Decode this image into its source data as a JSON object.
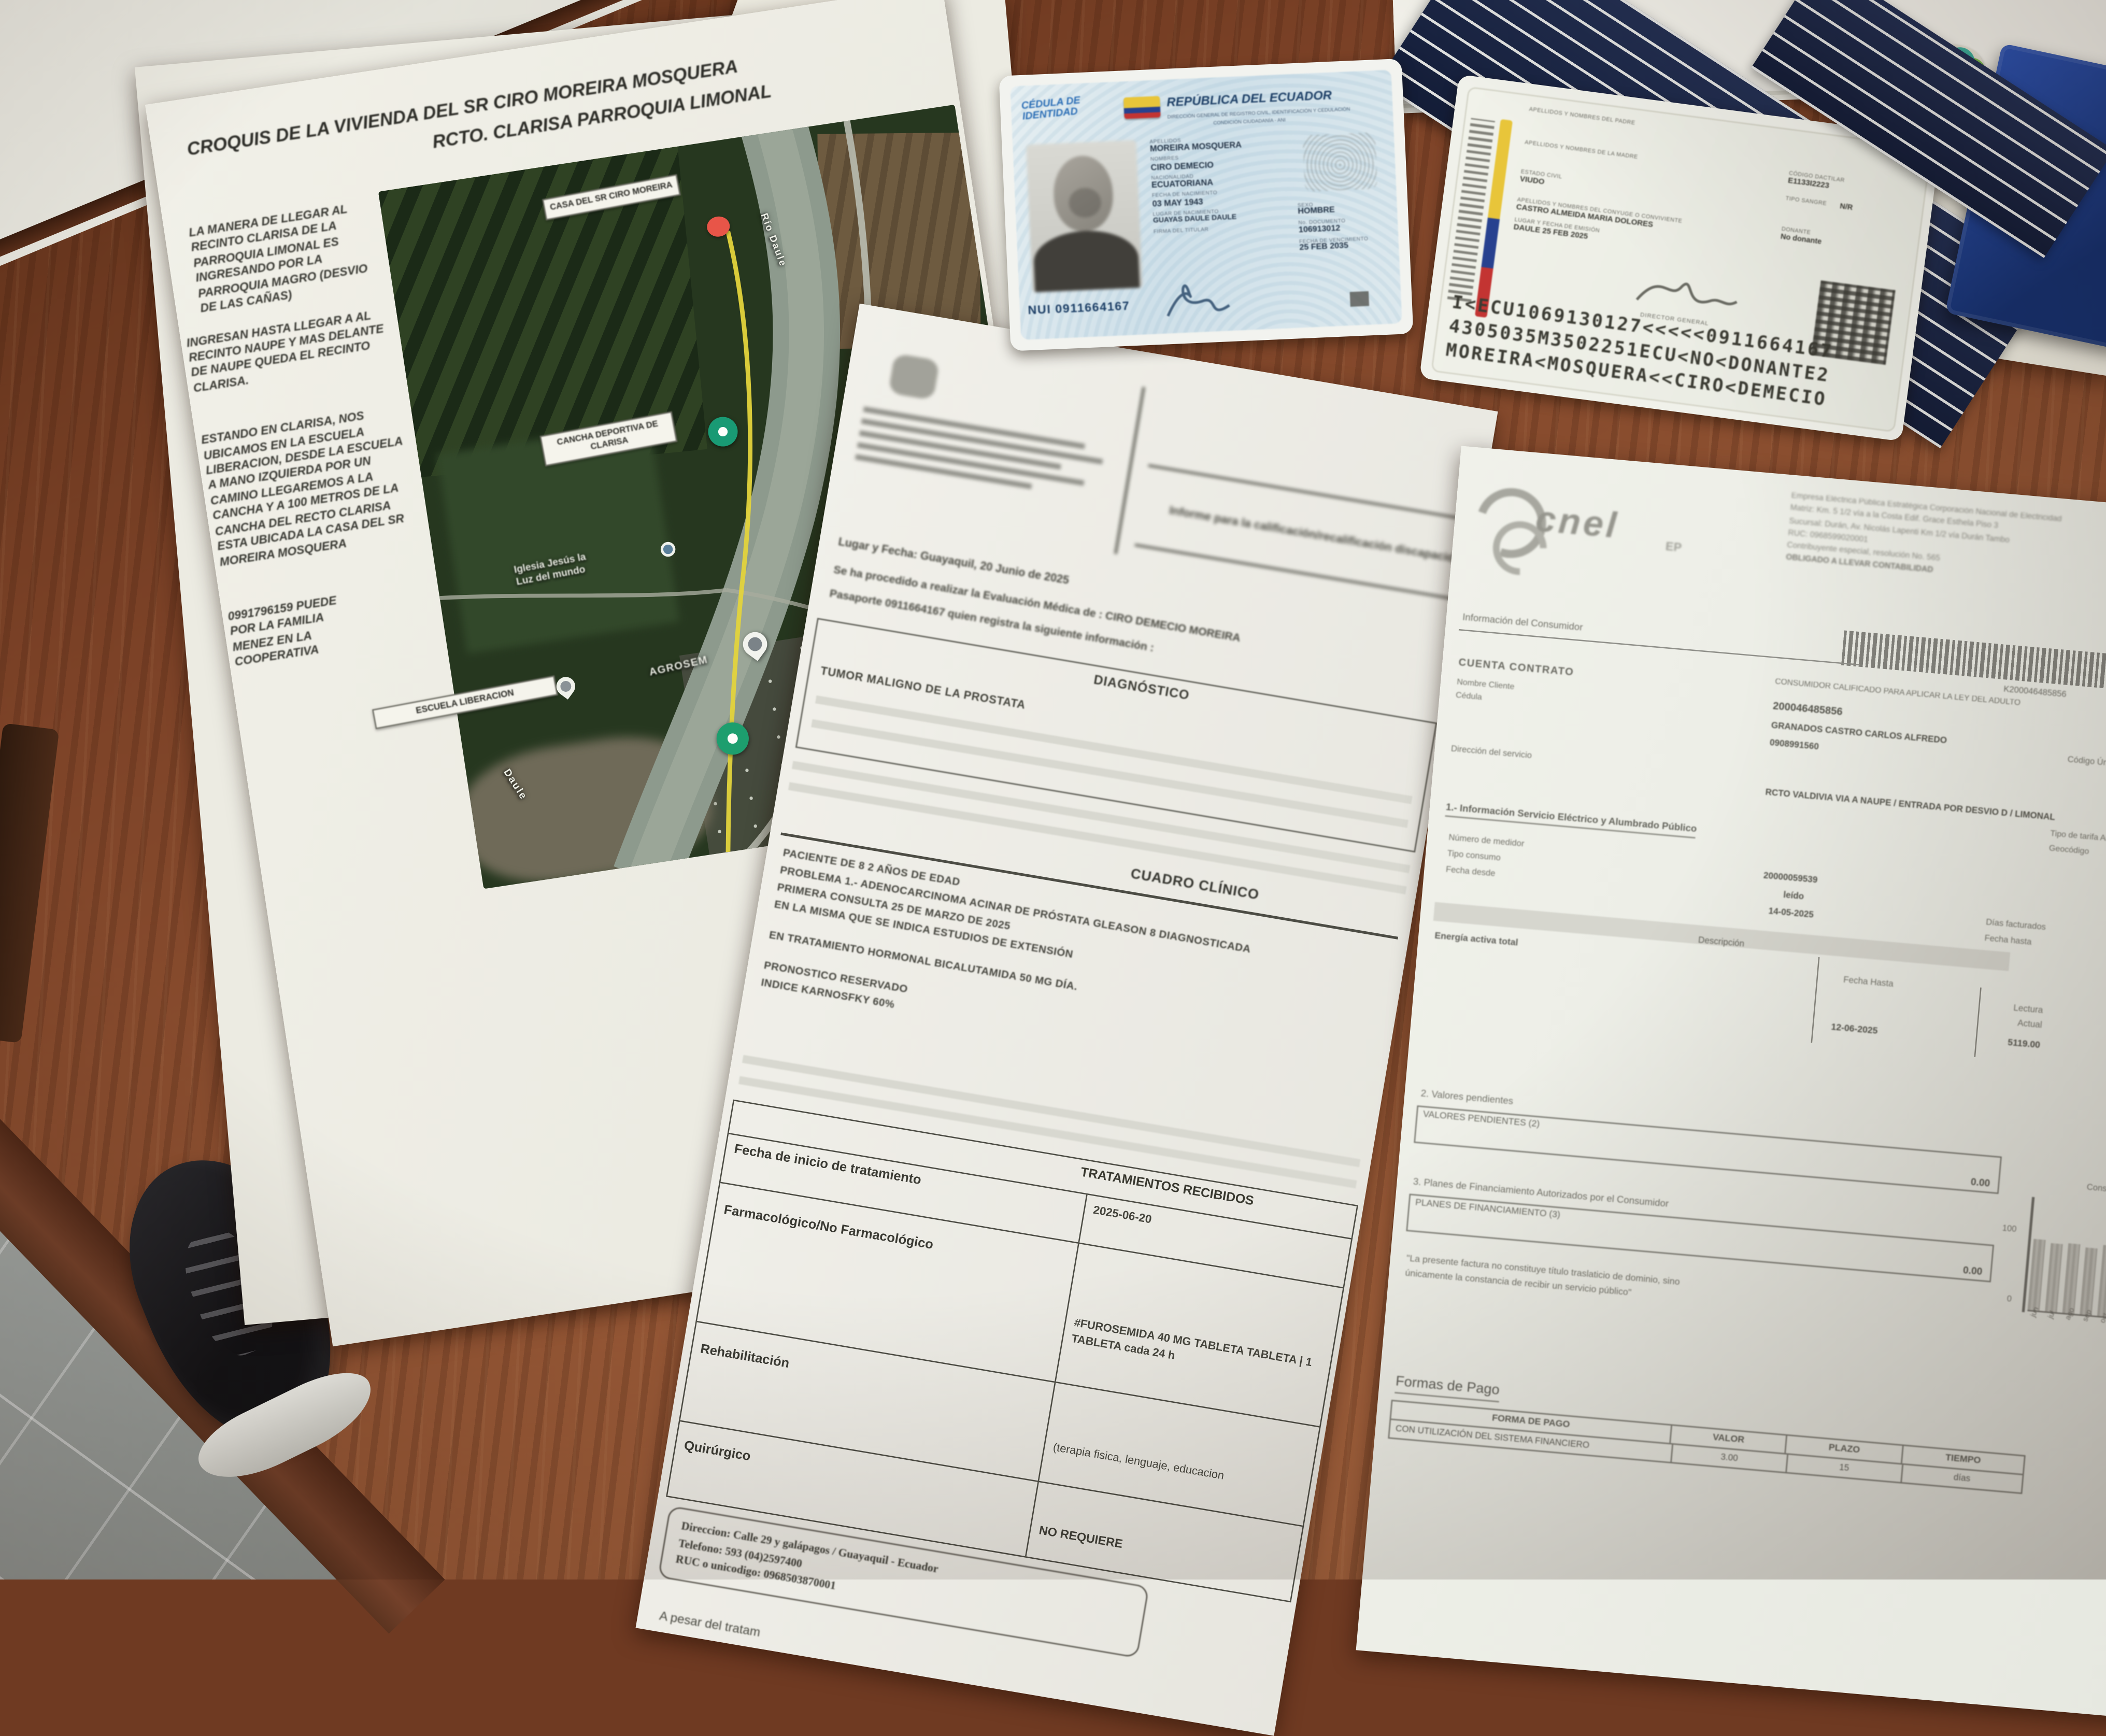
{
  "croquis": {
    "title_line1": "CROQUIS DE LA VIVIENDA DEL SR CIRO MOREIRA MOSQUERA",
    "title_line2": "RCTO. CLARISA PARROQUIA LIMONAL",
    "paragraph1": "LA MANERA DE LLEGAR AL RECINTO CLARISA DE LA PARROQUIA LIMONAL ES INGRESANDO POR LA PARROQUIA MAGRO (DESVIO DE LAS CAÑAS)",
    "paragraph2": "INGRESAN HASTA LLEGAR A AL RECINTO NAUPE Y MAS DELANTE DE NAUPE QUEDA EL RECINTO CLARISA.",
    "paragraph3": "ESTANDO EN CLARISA, NOS UBICAMOS EN LA ESCUELA LIBERACION, DESDE LA ESCUELA A MANO IZQUIERDA POR UN CAMINO LLEGAREMOS A LA CANCHA Y A 100 METROS DE LA CANCHA DEL RECTO CLARISA ESTA UBICADA LA CASA DEL SR MOREIRA MOSQUERA",
    "paragraph4_lines": [
      "0991796159 PUEDE",
      "POR LA FAMILIA",
      "MENEZ EN LA",
      "COOPERATIVA"
    ],
    "map": {
      "label_casa": "CASA DEL SR CIRO MOREIRA",
      "label_cancha": "CANCHA DEPORTIVA DE CLARISA",
      "label_escuela": "ESCUELA LIBERACION",
      "label_iglesia_1": "Iglesia Jesús la",
      "label_iglesia_2": "Luz del mundo",
      "label_agrosem": "AGROSEM",
      "label_rio": "Río Daule",
      "label_rio_2": "Daule"
    }
  },
  "id_front": {
    "doc_type_1": "CÉDULA DE",
    "doc_type_2": "IDENTIDAD",
    "country": "REPÚBLICA DEL ECUADOR",
    "org_line": "DIRECCIÓN GENERAL DE REGISTRO CIVIL, IDENTIFICACIÓN Y CEDULACIÓN",
    "cond_line": "CONDICIÓN CIUDADANÍA - ANI",
    "apellidos_label": "APELLIDOS",
    "apellidos": "MOREIRA MOSQUERA",
    "nombres_label": "NOMBRES",
    "nombres": "CIRO DEMECIO",
    "nacionalidad_label": "NACIONALIDAD",
    "nacionalidad": "ECUATORIANA",
    "fecha_nac_label": "FECHA DE NACIMIENTO",
    "fecha_nac": "03 MAY 1943",
    "lugar_nac_label": "LUGAR DE NACIMIENTO",
    "lugar_nac": "GUAYAS DAULE DAULE",
    "firma_label": "FIRMA DEL TITULAR",
    "sexo_label": "SEXO",
    "sexo": "HOMBRE",
    "documento_label": "No. DOCUMENTO",
    "documento": "106913012",
    "vencimiento_label": "FECHA DE VENCIMIENTO",
    "vencimiento": "25 FEB 2035",
    "nui": "NUI 0911664167"
  },
  "id_back": {
    "padre_label": "APELLIDOS Y NOMBRES DEL PADRE",
    "madre_label": "APELLIDOS Y NOMBRES DE LA MADRE",
    "estado_label": "ESTADO CIVIL",
    "estado": "VIUDO",
    "conyuge_label": "APELLIDOS Y NOMBRES DEL CÓNYUGE O CONVIVIENTE",
    "conyuge": "CASTRO ALMEIDA MARIA DOLORES",
    "emision_label": "LUGAR Y FECHA DE EMISIÓN",
    "emision": "DAULE 25 FEB 2025",
    "dactilar_label": "CÓDIGO DACTILAR",
    "dactilar": "E1133I2223",
    "sangre_label": "TIPO SANGRE",
    "sangre": "N/R",
    "donante_label": "DONANTE",
    "donante": "No donante",
    "director": "DIRECTOR GENERAL",
    "mrz1": "I<ECU1069130127<<<<<0911664167",
    "mrz2": "4305035M3502251ECU<NO<DONANTE2",
    "mrz3": "MOREIRA<MOSQUERA<<CIRO<DEMECIO"
  },
  "medical": {
    "header_title": "Informe para la calificación/recalificación discapacidad",
    "lugar_fecha": "Lugar y Fecha: Guayaquil, 20 Junio de 2025",
    "intro1": "Se ha procedido a realizar la Evaluación Médica de : CIRO DEMECIO MOREIRA",
    "intro2": "Pasaporte 0911664167  quien registra la siguiente información :",
    "diagnostico_header": "DIAGNÓSTICO",
    "diagnostico": "TUMOR MALIGNO DE LA PROSTATA",
    "cuadro_header": "CUADRO CLÍNICO",
    "c1": "PACIENTE DE 8 2 AÑOS DE EDAD",
    "c2": "PROBLEMA 1.- ADENOCARCINOMA ACINAR DE PRÓSTATA GLEASON 8 DIAGNOSTICADA",
    "c3": "PRIMERA CONSULTA 25 DE MARZO DE 2025",
    "c4": "EN LA MISMA QUE SE INDICA ESTUDIOS DE EXTENSIÓN",
    "c5": "EN TRATAMIENTO HORMONAL BICALUTAMIDA 50 MG DÍA.",
    "c6": "PRONOSTICO RESERVADO",
    "c7": "INDICE KARNOSFKY 60%",
    "tratamientos_header": "TRATAMIENTOS RECIBIDOS",
    "rows": [
      {
        "label": "Fecha de inicio de tratamiento",
        "value": "2025-06-20"
      },
      {
        "label": "Farmacológico/No Farmacológico",
        "value": "#FUROSEMIDA 40 MG TABLETA TABLETA | 1 TABLETA cada 24 h"
      },
      {
        "label": "Rehabilitación",
        "value": "(terapia fisica, lenguaje, educacion"
      },
      {
        "label": "Quirúrgico",
        "value": "NO REQUIERE"
      }
    ],
    "direccion": "Direccion: Calle 29 y galápagos / Guayaquil - Ecuador",
    "telefono": "Telefono: 593 (04)2597400",
    "ruc": "RUC o unicodigo: 0968503870001",
    "bottom_text": "A pesar del tratam"
  },
  "bill": {
    "company_lines": [
      "Empresa Eléctrica Pública Estratégica Corporación Nacional de Electricidad",
      "Matriz: Km. 5 1/2 vía a la Costa Edif. Grace Esthela Piso 3",
      "Sucursal: Durán, Av. Nicolás Lapenti Km 1/2 vía Durán Tambo",
      "RUC: 0968599020001",
      "Contribuyente especial, resolución No. 565",
      "OBLIGADO A LLEVAR CONTABILIDAD"
    ],
    "logo_text": "cnel",
    "logo_sub": "EP",
    "barcode_number": "K200046485856",
    "sec_consumidor": "Información del Consumidor",
    "cuenta_label": "CUENTA CONTRATO",
    "cuenta": "200046485856",
    "calificado": "CONSUMIDOR CALIFICADO PARA APLICAR LA LEY DEL ADULTO",
    "nombre_label": "Nombre Cliente",
    "cedula_label": "Cédula",
    "nombre": "GRANADOS CASTRO CARLOS ALFREDO",
    "cedula": "0908991560",
    "codigo_unico": "Código Único",
    "direccion_label": "Dirección del servicio",
    "direccion": "RCTO VALDIVIA VIA A NAUPE / ENTRADA POR DESVIO D / LIMONAL",
    "tarifa": "Tipo de tarifa  Arconel",
    "geocodigo": "Geocódigo",
    "sec1": "1.- Información Servicio Eléctrico y Alumbrado Público",
    "medidor_label": "Número de medidor",
    "medidor": "20000059539",
    "tipo_label": "Tipo consumo",
    "tipo": "leído",
    "desde_label": "Fecha desde",
    "desde": "14-05-2025",
    "dias_label": "Días facturados",
    "hasta_label": "Fecha hasta",
    "descripcion": "Descripción",
    "energia": "Energía activa total",
    "col_fecha_hasta": "Fecha Hasta",
    "col_lectura_1": "Lectura",
    "col_lectura_2": "Actual",
    "col_lectura_ant_1": "Lectu",
    "col_lectura_ant_2": "Ante",
    "fecha_hasta_val": "12-06-2025",
    "lectura_actual": "5119.00",
    "lectura_anterior": "5007",
    "sec2": "2. Valores pendientes",
    "box2": "VALORES PENDIENTES (2)",
    "val2": "0.00",
    "sec3": "3. Planes de Financiamiento Autorizados por el Consumidor",
    "box3": "PLANES DE FINANCIAMIENTO (3)",
    "val3": "0.00",
    "chart": {
      "title": "Consumo",
      "y_max": "100",
      "y_min": "0",
      "months": [
        "jun",
        "jul",
        "ago",
        "sep",
        "oct",
        "nov",
        "dic"
      ],
      "values": [
        95,
        91,
        93,
        89,
        94,
        90,
        92
      ]
    },
    "quote": "\"La presente factura no constituye título traslaticio de dominio, sino únicamente la constancia de recibir un servicio público\"",
    "formas_pago": "Formas de Pago",
    "pay_headers": [
      "FORMA DE PAGO",
      "VALOR",
      "PLAZO",
      "TIEMPO"
    ],
    "pay_row": [
      "CON UTILIZACIÓN DEL SISTEMA FINANCIERO",
      "3.00",
      "15",
      "días"
    ]
  },
  "palette": {
    "desk": "#8a4a2c",
    "wall": "#e8e7df",
    "floor": "#9aa09e",
    "flag_yellow": "#e8c53a",
    "flag_blue": "#27418f",
    "flag_red": "#c33432",
    "marker_red": "#e85548",
    "marker_teal": "#199a74",
    "path_yellow": "#e3d33c",
    "card_blue": "#1d3f66",
    "navy_folder": "#1b2746",
    "notebook_blue": "#24449c"
  }
}
